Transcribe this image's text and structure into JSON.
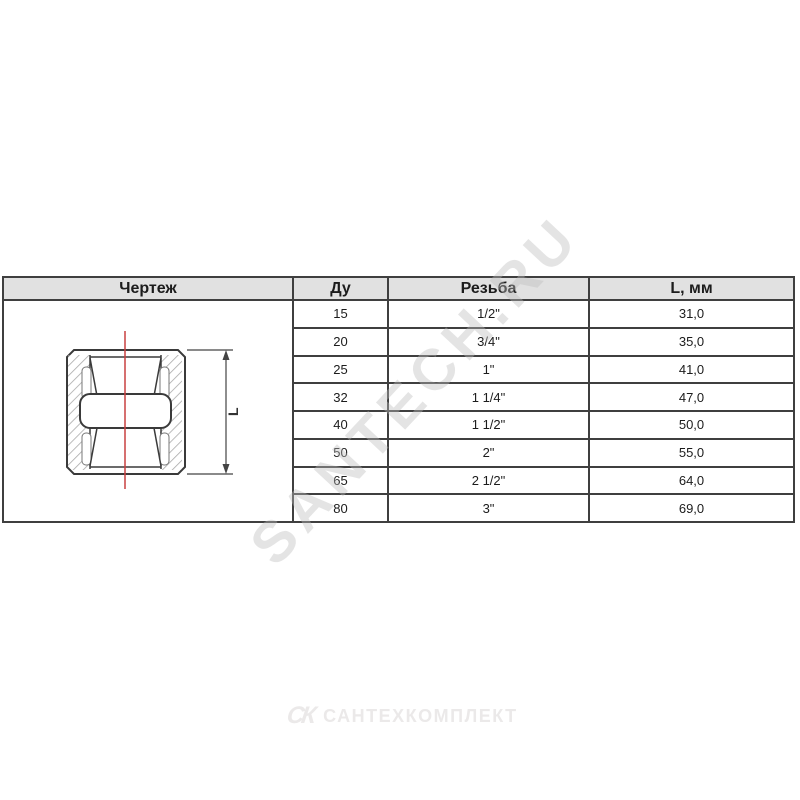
{
  "watermark": "SANTECH.RU",
  "table": {
    "headers": {
      "drawing": "Чертеж",
      "dn": "Ду",
      "thread": "Резьба",
      "length": "L, мм"
    },
    "rows": [
      {
        "du": "15",
        "thread": "1/2\"",
        "l": "31,0"
      },
      {
        "du": "20",
        "thread": "3/4\"",
        "l": "35,0"
      },
      {
        "du": "25",
        "thread": "1\"",
        "l": "41,0"
      },
      {
        "du": "32",
        "thread": "1 1/4\"",
        "l": "47,0"
      },
      {
        "du": "40",
        "thread": "1 1/2\"",
        "l": "50,0"
      },
      {
        "du": "50",
        "thread": "2\"",
        "l": "55,0"
      },
      {
        "du": "65",
        "thread": "2 1/2\"",
        "l": "64,0"
      },
      {
        "du": "80",
        "thread": "3\"",
        "l": "69,0"
      }
    ]
  },
  "drawing": {
    "dimension_label": "L"
  },
  "footer": {
    "mark": "СК",
    "text": "САНТЕХКОМПЛЕКТ"
  },
  "colors": {
    "header_bg": "#e1e1e1",
    "border_color": "#3f3f3f",
    "text_color": "#1c1c1c",
    "centerline_color": "#c94040",
    "watermark_color": "#bdbdbd",
    "footer_color": "#ebe9e9"
  }
}
